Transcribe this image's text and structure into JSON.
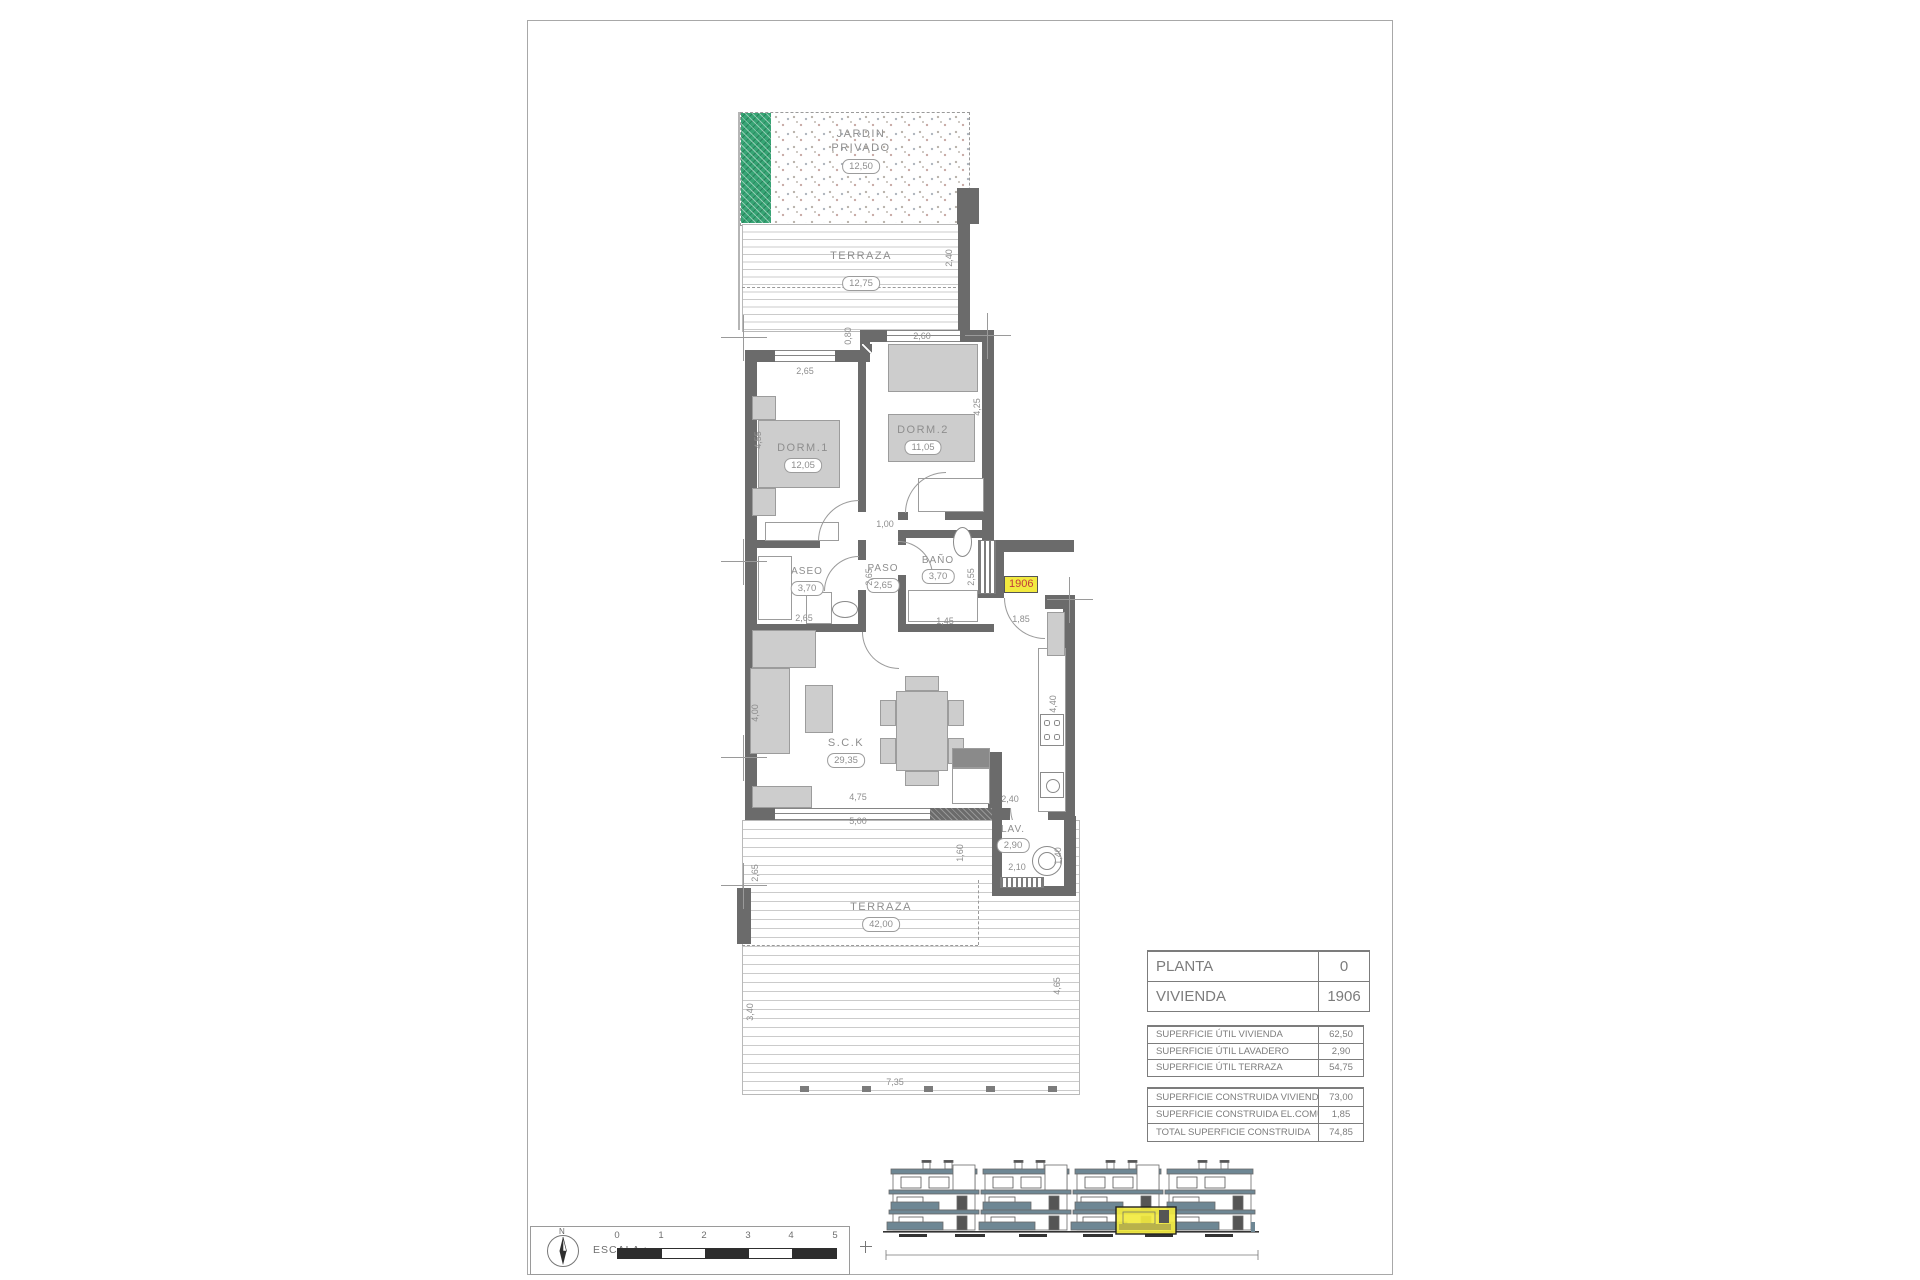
{
  "colors": {
    "wall_gray": "#6b6b6b",
    "garden_green": "#36a474",
    "deck_line_gray": "#cbcbcb",
    "highlight_yellow": "#f2ea3f",
    "badge_text_red": "#c23b3b",
    "elevation_slate": "#6e8794"
  },
  "plan": {
    "garden": {
      "line1": "JARDIN",
      "line2": "PRIVADO",
      "value": "12,50"
    },
    "terrace_top": {
      "label": "TERRAZA",
      "value": "12,75"
    },
    "dorm1": {
      "label": "DORM.1",
      "value": "12,05"
    },
    "dorm2": {
      "label": "DORM.2",
      "value": "11,05"
    },
    "aseo": {
      "label": "ASEO",
      "value": "3,70"
    },
    "paso": {
      "label": "PASO",
      "value": "2,65"
    },
    "bano": {
      "label": "BAÑO",
      "value": "3,70"
    },
    "sck": {
      "label": "S.C.K",
      "value": "29,35"
    },
    "lav": {
      "label": "LAV.",
      "value": "2,90"
    },
    "terrace_bottom": {
      "label": "TERRAZA",
      "value": "42,00"
    },
    "unit_badge": "1906",
    "dimensions": [
      {
        "text": "2,60",
        "x": 922,
        "y": 336
      },
      {
        "text": "0,80",
        "x": 848,
        "y": 336,
        "rot": -90
      },
      {
        "text": "2,40",
        "x": 949,
        "y": 258,
        "rot": -90
      },
      {
        "text": "2,65",
        "x": 805,
        "y": 371
      },
      {
        "text": "4,55",
        "x": 758,
        "y": 440,
        "rot": -90
      },
      {
        "text": "4,25",
        "x": 977,
        "y": 407,
        "rot": -90
      },
      {
        "text": "1,00",
        "x": 885,
        "y": 524
      },
      {
        "text": "2,65",
        "x": 869,
        "y": 577,
        "rot": -90
      },
      {
        "text": "2,65",
        "x": 804,
        "y": 618
      },
      {
        "text": "2,55",
        "x": 971,
        "y": 577,
        "rot": -90
      },
      {
        "text": "1,45",
        "x": 945,
        "y": 621
      },
      {
        "text": "1,85",
        "x": 1021,
        "y": 619
      },
      {
        "text": "4,00",
        "x": 755,
        "y": 713,
        "rot": -90
      },
      {
        "text": "4,40",
        "x": 1053,
        "y": 704,
        "rot": -90
      },
      {
        "text": "2,40",
        "x": 1010,
        "y": 799
      },
      {
        "text": "4,75",
        "x": 858,
        "y": 797
      },
      {
        "text": "5,00",
        "x": 858,
        "y": 821
      },
      {
        "text": "1,60",
        "x": 960,
        "y": 853,
        "rot": -90
      },
      {
        "text": "2,10",
        "x": 1017,
        "y": 867
      },
      {
        "text": "1,40",
        "x": 1058,
        "y": 856,
        "rot": -90
      },
      {
        "text": "2,65",
        "x": 755,
        "y": 873,
        "rot": -90
      },
      {
        "text": "3,40",
        "x": 750,
        "y": 1012,
        "rot": -90
      },
      {
        "text": "4,65",
        "x": 1057,
        "y": 986,
        "rot": -90
      },
      {
        "text": "7,35",
        "x": 895,
        "y": 1082
      }
    ]
  },
  "tables": {
    "unit": {
      "rows": [
        {
          "label": "PLANTA",
          "value": "0"
        },
        {
          "label": "VIVIENDA",
          "value": "1906"
        }
      ]
    },
    "useful": {
      "rows": [
        {
          "label": "SUPERFICIE ÚTIL VIVIENDA",
          "value": "62,50"
        },
        {
          "label": "SUPERFICIE ÚTIL LAVADERO",
          "value": "2,90"
        },
        {
          "label": "SUPERFICIE ÚTIL TERRAZA",
          "value": "54,75"
        }
      ]
    },
    "built": {
      "rows": [
        {
          "label": "SUPERFICIE CONSTRUIDA VIVIENDA",
          "value": "73,00"
        },
        {
          "label": "SUPERFICIE CONSTRUIDA EL.COMUNES",
          "value": "1,85"
        },
        {
          "label": "TOTAL SUPERFICIE CONSTRUIDA",
          "value": "74,85"
        }
      ]
    }
  },
  "scalebox": {
    "north": "N",
    "label": "ESCALA :",
    "ticks": [
      {
        "text": "0",
        "x": 0
      },
      {
        "text": "1",
        "x": 44
      },
      {
        "text": "2",
        "x": 87
      },
      {
        "text": "3",
        "x": 131
      },
      {
        "text": "4",
        "x": 174
      },
      {
        "text": "5",
        "x": 218
      }
    ]
  }
}
